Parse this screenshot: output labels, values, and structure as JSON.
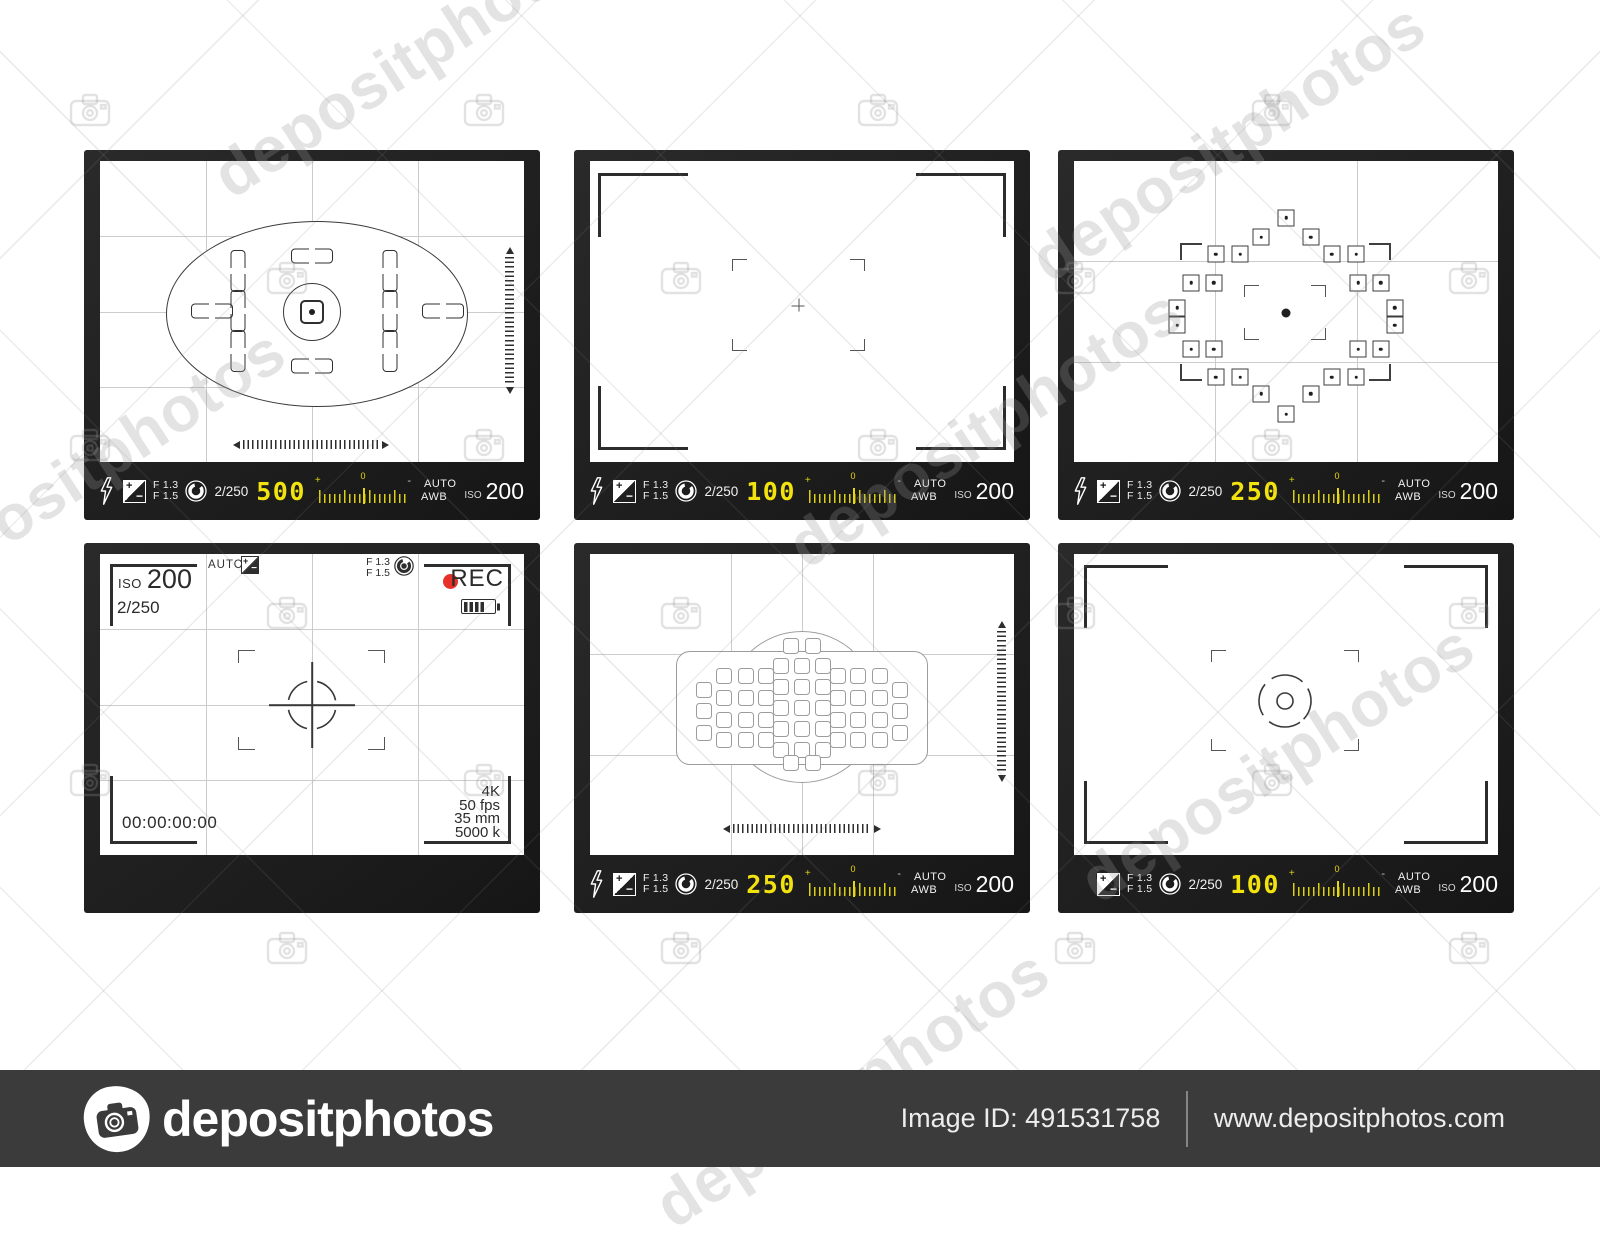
{
  "watermark": {
    "text": "depositphotos"
  },
  "footer": {
    "logo_text": "depositphotos",
    "image_id": "Image ID: 491531758",
    "site": "www.depositphotos.com"
  },
  "colors": {
    "accent_yellow": "#f2e20e",
    "rec_red": "#e8302a",
    "frame_dark": "#1d1d1d",
    "footer_bg": "#3b3b3b"
  },
  "ruler": {
    "plus": "+",
    "zero": "0",
    "minus": "-"
  },
  "viewfinders": [
    {
      "name": "focusing-screen-ellipse",
      "bar": {
        "f1": "F 1.3",
        "f2": "F 1.5",
        "shutter": "2/250",
        "value": "500",
        "auto": "AUTO",
        "awb": "AWB",
        "iso": "ISO",
        "iso_value": "200"
      },
      "graphics": {
        "vpairs": [
          [
            32.5,
            36.5
          ],
          [
            32.5,
            49.8
          ],
          [
            32.5,
            63.1
          ],
          [
            68.4,
            36.5
          ],
          [
            68.4,
            49.8
          ],
          [
            68.4,
            63.1
          ]
        ],
        "hpairs": [
          [
            50,
            31.6
          ],
          [
            50,
            68.1
          ],
          [
            26.4,
            49.8
          ],
          [
            80.9,
            49.8
          ]
        ]
      }
    },
    {
      "name": "frame-crosshair",
      "bar": {
        "f1": "F 1.3",
        "f2": "F 1.5",
        "shutter": "2/250",
        "value": "100",
        "auto": "AUTO",
        "awb": "AWB",
        "iso": "ISO",
        "iso_value": "200"
      }
    },
    {
      "name": "af-point-diamond",
      "bar": {
        "f1": "F 1.3",
        "f2": "F 1.5",
        "shutter": "2/250",
        "value": "250",
        "auto": "AUTO",
        "awb": "AWB",
        "iso": "ISO",
        "iso_value": "200"
      },
      "focus_points": [
        [
          50,
          18.9
        ],
        [
          44.2,
          25.3
        ],
        [
          55.8,
          25.3
        ],
        [
          33.4,
          30.9
        ],
        [
          39.2,
          30.9
        ],
        [
          60.8,
          30.9
        ],
        [
          66.6,
          30.9
        ],
        [
          27.6,
          40.4
        ],
        [
          33.0,
          40.4
        ],
        [
          67.0,
          40.4
        ],
        [
          72.4,
          40.4
        ],
        [
          24.4,
          48.8
        ],
        [
          75.6,
          48.8
        ],
        [
          24.4,
          54.5
        ],
        [
          75.6,
          54.5
        ],
        [
          27.6,
          62.6
        ],
        [
          33.0,
          62.6
        ],
        [
          67.0,
          62.6
        ],
        [
          72.4,
          62.6
        ],
        [
          33.4,
          71.9
        ],
        [
          39.2,
          71.9
        ],
        [
          60.8,
          71.9
        ],
        [
          66.6,
          71.9
        ],
        [
          44.2,
          77.4
        ],
        [
          55.8,
          77.4
        ],
        [
          50,
          84.1
        ]
      ]
    },
    {
      "name": "video-rec-overlay",
      "overlay": {
        "iso": "ISO",
        "iso_value": "200",
        "shutter": "2/250",
        "auto": "AUTO",
        "f1": "F 1.3",
        "f2": "F 1.5",
        "rec": "REC",
        "timecode": "00:00:00:00",
        "specs": [
          "4K",
          "50 fps",
          "35 mm",
          "5000 k"
        ]
      }
    },
    {
      "name": "af-grid-screen",
      "bar": {
        "f1": "F 1.3",
        "f2": "F 1.5",
        "shutter": "2/250",
        "value": "250",
        "auto": "AUTO",
        "awb": "AWB",
        "iso": "ISO",
        "iso_value": "200"
      },
      "af_squares": [
        [
          45,
          37.2
        ],
        [
          50,
          37.2
        ],
        [
          55,
          37.2
        ],
        [
          45,
          44.2
        ],
        [
          50,
          44.2
        ],
        [
          55,
          44.2
        ],
        [
          45,
          51.2
        ],
        [
          50,
          51.2
        ],
        [
          55,
          51.2
        ],
        [
          45,
          58.1
        ],
        [
          50,
          58.1
        ],
        [
          55,
          58.1
        ],
        [
          45,
          65.1
        ],
        [
          50,
          65.1
        ],
        [
          55,
          65.1
        ],
        [
          31.7,
          40.5
        ],
        [
          36.7,
          40.5
        ],
        [
          41.4,
          40.5
        ],
        [
          31.7,
          47.8
        ],
        [
          36.7,
          47.8
        ],
        [
          41.4,
          47.8
        ],
        [
          31.7,
          55.1
        ],
        [
          36.7,
          55.1
        ],
        [
          41.4,
          55.1
        ],
        [
          31.7,
          61.8
        ],
        [
          36.7,
          61.8
        ],
        [
          41.4,
          61.8
        ],
        [
          58.6,
          40.5
        ],
        [
          63.3,
          40.5
        ],
        [
          68.3,
          40.5
        ],
        [
          58.6,
          47.8
        ],
        [
          63.3,
          47.8
        ],
        [
          68.3,
          47.8
        ],
        [
          58.6,
          55.1
        ],
        [
          63.3,
          55.1
        ],
        [
          68.3,
          55.1
        ],
        [
          58.6,
          61.8
        ],
        [
          63.3,
          61.8
        ],
        [
          68.3,
          61.8
        ],
        [
          26.8,
          45.2
        ],
        [
          26.8,
          52.2
        ],
        [
          26.8,
          59.5
        ],
        [
          73.2,
          45.2
        ],
        [
          73.2,
          52.2
        ],
        [
          73.2,
          59.5
        ],
        [
          47.5,
          30.6
        ],
        [
          52.5,
          30.6
        ],
        [
          47.5,
          69.4
        ],
        [
          52.5,
          69.4
        ]
      ]
    },
    {
      "name": "frame-circle-target",
      "bar": {
        "f1": "F 1.3",
        "f2": "F 1.5",
        "shutter": "2/250",
        "value": "100",
        "auto": "AUTO",
        "awb": "AWB",
        "iso": "ISO",
        "iso_value": "200"
      }
    }
  ]
}
